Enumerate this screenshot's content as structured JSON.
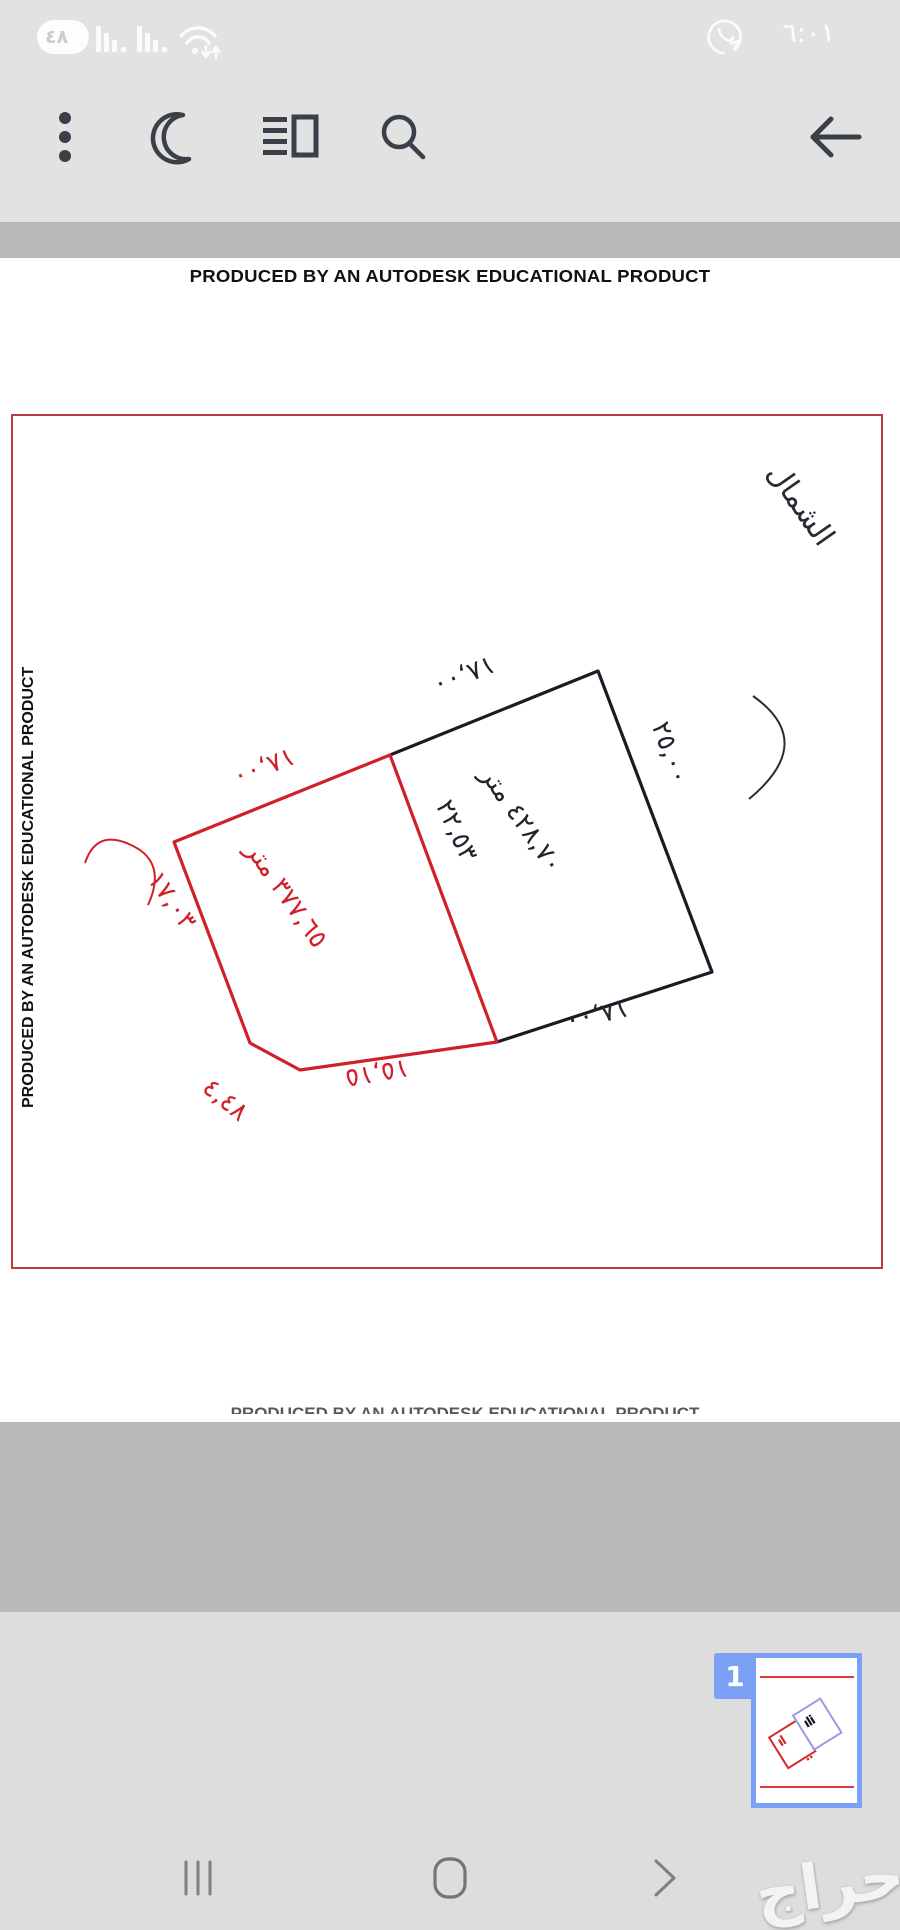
{
  "status_bar": {
    "battery_percent": "٤٨",
    "time": "٦:٠١",
    "icons": [
      "battery-indicator",
      "signal-sim1",
      "signal-sim2",
      "wifi",
      "whatsapp-notification"
    ]
  },
  "toolbar": {
    "icons": [
      "kebab-menu",
      "dark-mode-moon",
      "reader-view",
      "search",
      "back-arrow"
    ]
  },
  "document": {
    "watermark_top": "PRODUCED BY AN AUTODESK EDUCATIONAL PRODUCT",
    "watermark_left": "PRODUCED BY AN AUTODESK EDUCATIONAL PRODUCT",
    "watermark_bottom": "PRODUCED BY AN AUTODESK EDUCATIONAL PRODUCT",
    "north_label": "الشمال",
    "plot": {
      "black_parcel": {
        "area_label": "٤٢٨,٧٠ متر",
        "dim_top": "١٨,٠٠",
        "dim_right": "٢٥,٠٠",
        "dim_bottom": "١٨,٠٠",
        "dim_divider": "٢٢,٥٣"
      },
      "red_parcel": {
        "area_label": "٣٧٧,٦٥ متر",
        "dim_top": "١٨,٠٠",
        "dim_left": "١٧,٠٣",
        "dim_chamfer": "٤,٤٨",
        "dim_bottom": "١٥,١٥"
      }
    },
    "colors": {
      "parcel_black": "#1b1b26",
      "parcel_red": "#cf2127",
      "page_border": "#bf3b3b",
      "thumbnail_accent": "#7ba0f5"
    }
  },
  "thumbnail": {
    "page_number": "1"
  },
  "nav_bar": {
    "icons": [
      "recents",
      "home",
      "back"
    ]
  },
  "brand_watermark": "حراج"
}
